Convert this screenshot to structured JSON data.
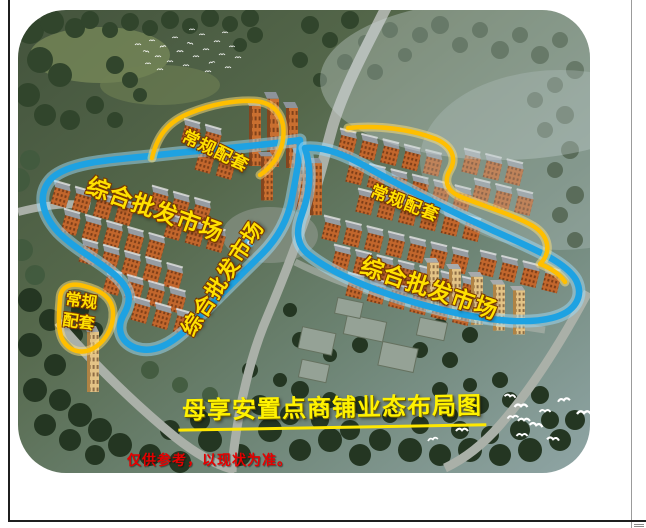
{
  "photo": {
    "title": "母享安置点商铺业态布局图",
    "disclaimer": "仅供参考，以现状为准。",
    "regions": [
      {
        "id": "wholesale-left",
        "label": "综合批发市场",
        "outline": "blue"
      },
      {
        "id": "wholesale-middle",
        "label": "综合批发市场",
        "outline": "blue"
      },
      {
        "id": "wholesale-right",
        "label": "综合批发市场",
        "outline": "blue"
      },
      {
        "id": "support-top",
        "label": "常规配套",
        "outline": "yellow"
      },
      {
        "id": "support-right",
        "label": "常规配套",
        "outline": "yellow"
      },
      {
        "id": "support-left",
        "label": "常规配套",
        "line1": "常规",
        "line2": "配套",
        "outline": "yellow"
      }
    ],
    "colors": {
      "annotation_blue": "#1EA2E2",
      "annotation_yellow": "#FFBF00",
      "label_yellow": "#FFE100",
      "title_yellow": "#FFF200",
      "disclaimer_red": "#E60000"
    }
  }
}
